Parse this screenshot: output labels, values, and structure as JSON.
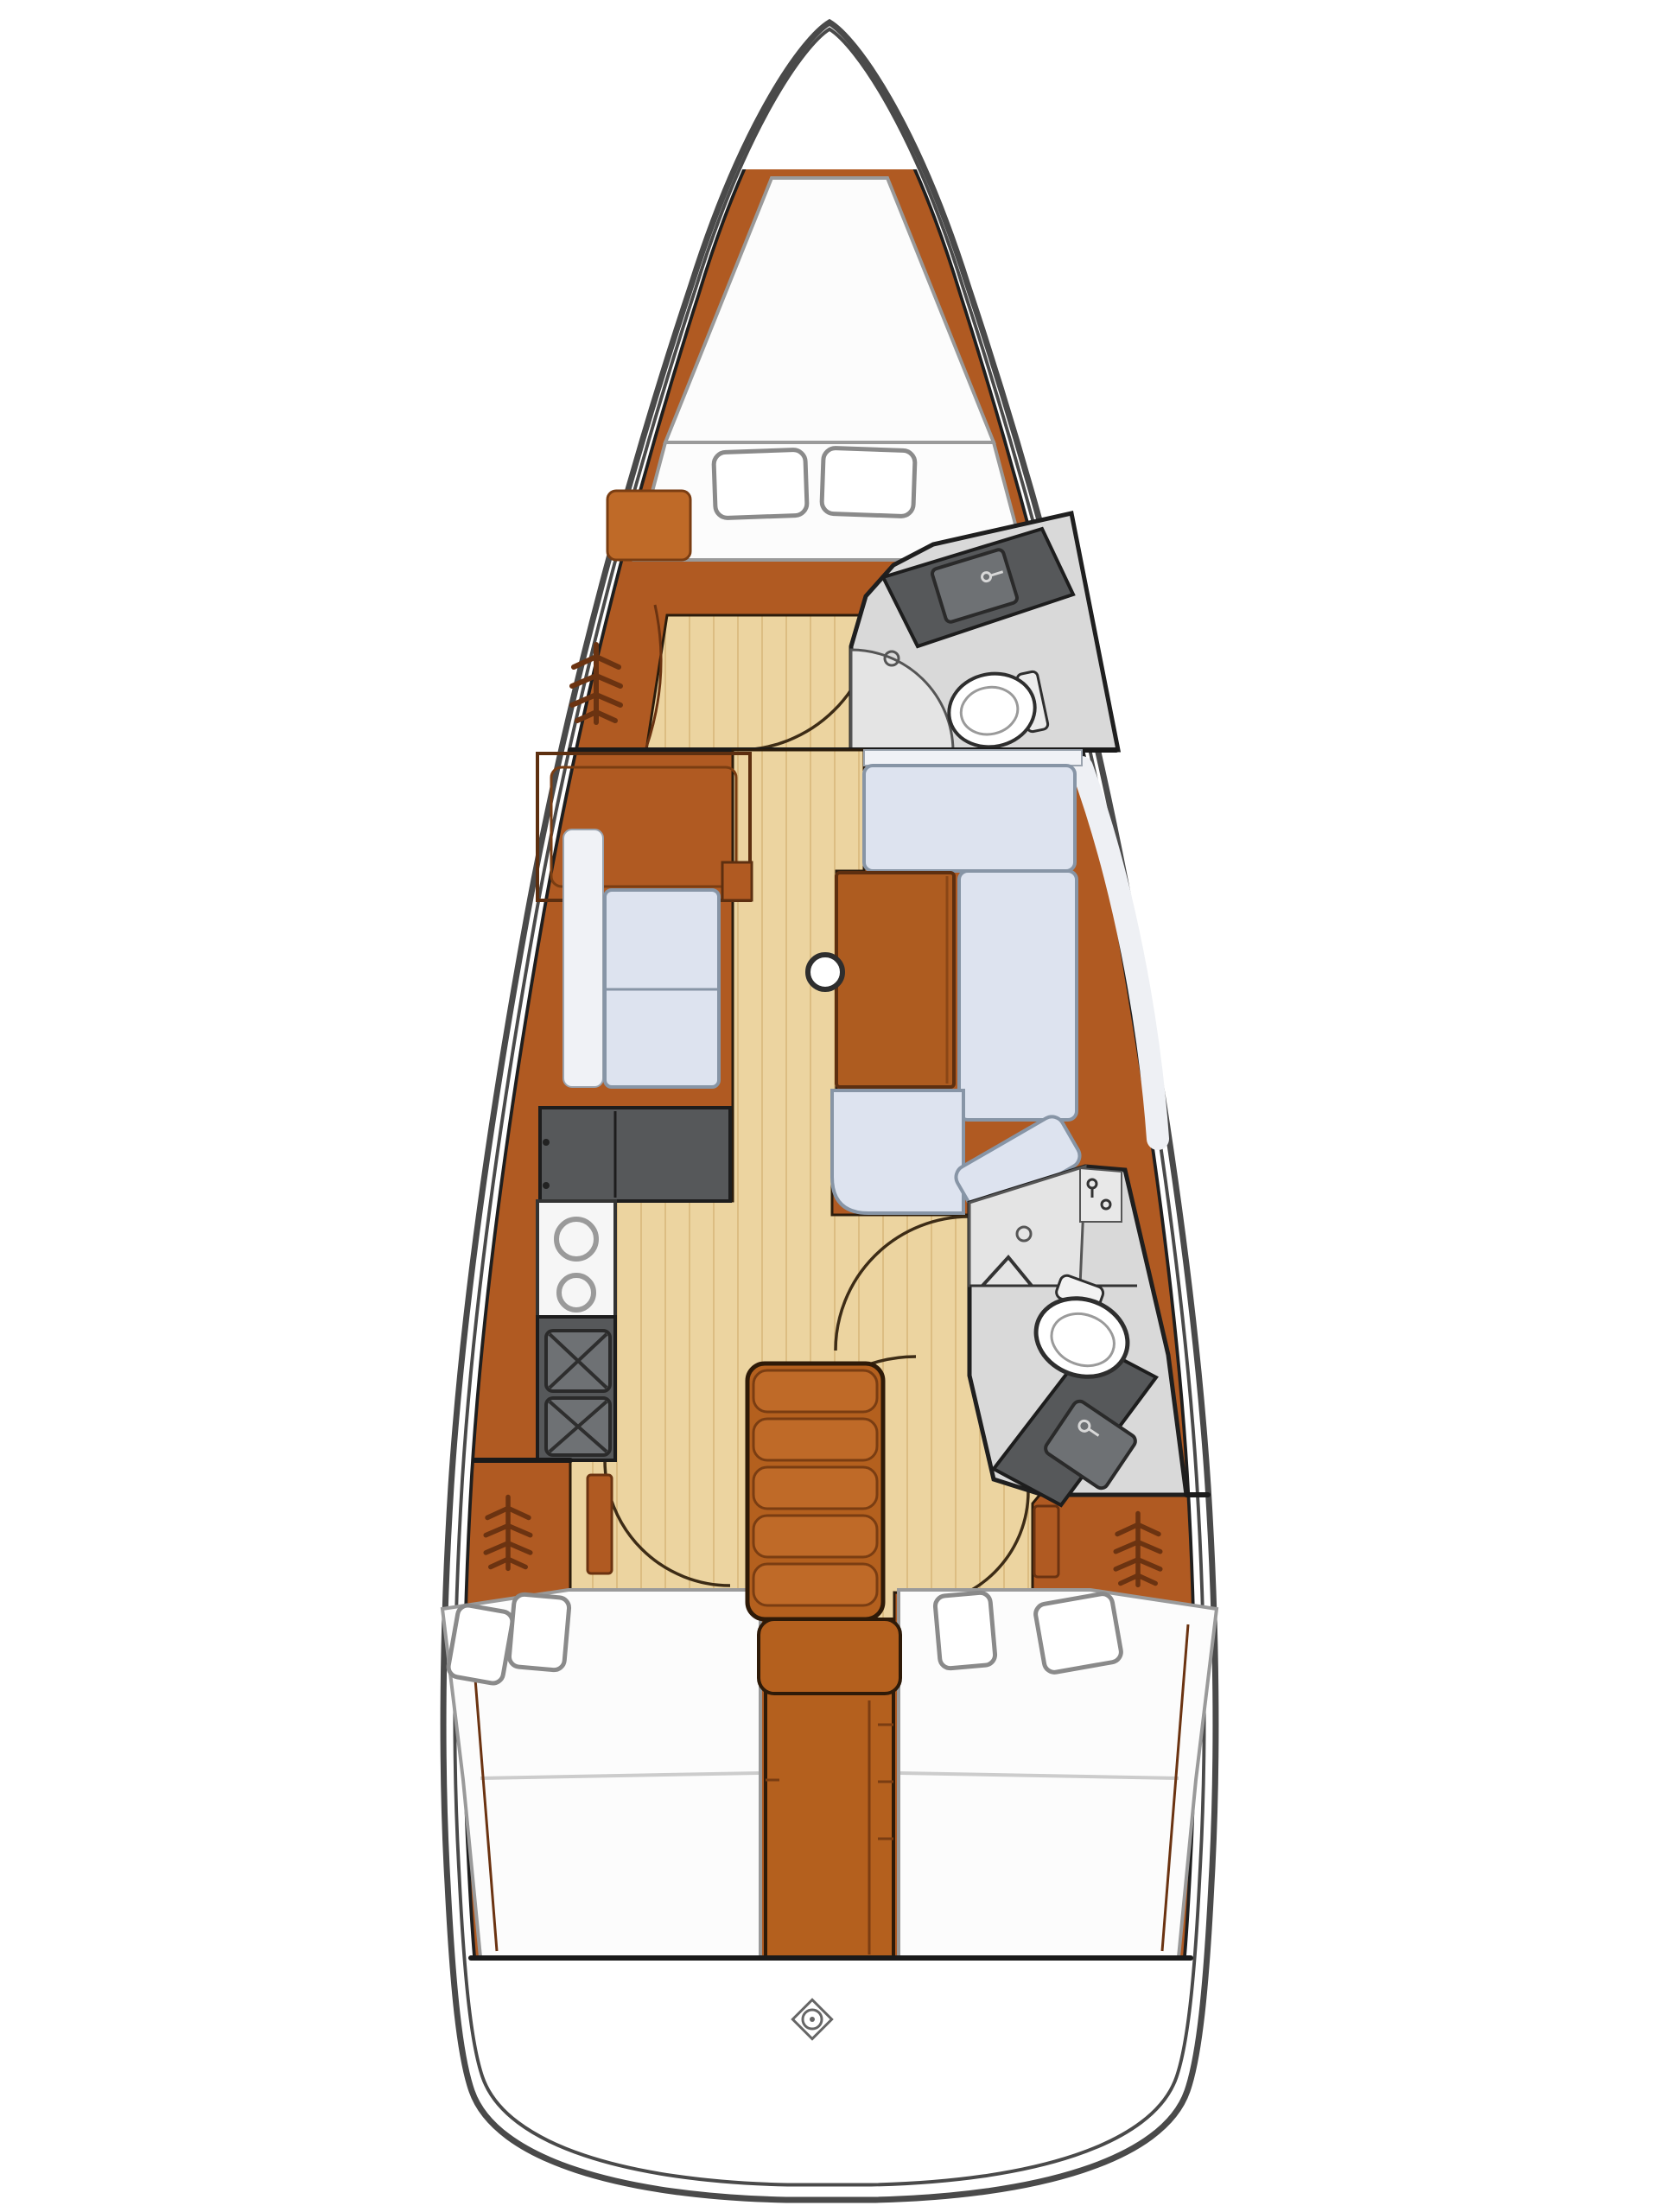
{
  "diagram": {
    "type": "floor-plan",
    "subject": "monohull-sailboat-interior-layout",
    "orientation": "bow-top-stern-bottom",
    "areas": [
      {
        "id": "v-berth",
        "label": "Forward cabin V-berth with two pillows"
      },
      {
        "id": "forward-cabin-lockers",
        "label": "Forward cabin port seat and hanging locker"
      },
      {
        "id": "forward-head",
        "label": "Forward head with toilet, corner sink and shower"
      },
      {
        "id": "salon-port",
        "label": "Port salon cabinet and two-seat settee"
      },
      {
        "id": "salon-dinette",
        "label": "Starboard U-shaped dinette with wooden table"
      },
      {
        "id": "galley",
        "label": "Port galley with counters, two-burner stove and twin sinks"
      },
      {
        "id": "companionway",
        "label": "Companionway with five steps and engine trunk"
      },
      {
        "id": "aft-head",
        "label": "Aft head with shower, toilet and corner sink"
      },
      {
        "id": "port-aft-cabin",
        "label": "Port aft double cabin with hanging locker"
      },
      {
        "id": "starboard-aft-cabin",
        "label": "Starboard aft double cabin with hanging locker"
      },
      {
        "id": "transom",
        "label": "Stern / transom platform with compass mark"
      }
    ],
    "icons": [
      {
        "name": "hanging-locker-icon",
        "count": 3
      },
      {
        "name": "mast-icon",
        "count": 1
      },
      {
        "name": "compass-icon",
        "count": 1
      },
      {
        "name": "toilet-icon",
        "count": 2
      },
      {
        "name": "sink-icon",
        "count": 3
      },
      {
        "name": "burner-icon",
        "count": 2
      },
      {
        "name": "shower-drain-icon",
        "count": 2
      },
      {
        "name": "door-swing-arc",
        "count": 5
      },
      {
        "name": "pillow",
        "count": 6
      }
    ],
    "colors": {
      "hull_line": "#4a4a4a",
      "structure_line": "#1f1f1f",
      "wood": "#b05a22",
      "wood_dark": "#6b3311",
      "floor": "#ecd4a0",
      "floor_stripe": "#dcbd82",
      "cushion": "#dde3ef",
      "cushion_edge": "#8795a6",
      "counter": "#56585a",
      "counter_inner": "#6e7174",
      "head_floor": "#d9d9d9",
      "shower_floor": "#e4e4e4",
      "bed": "#fcfcfc",
      "background": "#ffffff"
    }
  }
}
